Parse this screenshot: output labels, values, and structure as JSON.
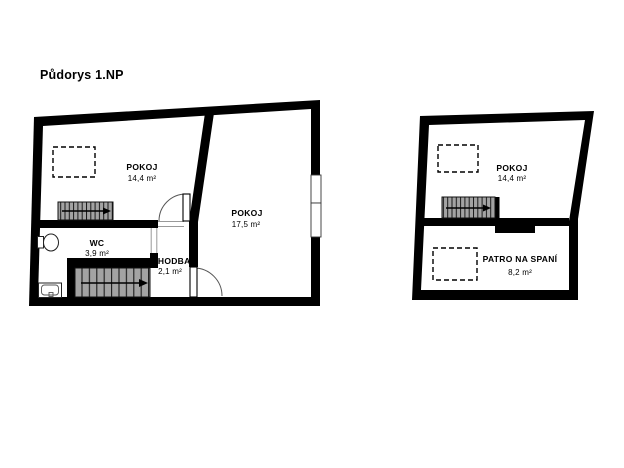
{
  "page": {
    "title": "Půdorys 1.NP",
    "background": "#ffffff"
  },
  "colors": {
    "wall": "#000000",
    "floor": "#ffffff",
    "stair_fill": "#a3a3a3",
    "tread_line": "#1a1a1a"
  },
  "plans": [
    {
      "id": "main-floor",
      "rooms": [
        {
          "label": "POKOJ",
          "area": "14,4 m²"
        },
        {
          "label": "POKOJ",
          "area": "17,5 m²"
        },
        {
          "label": "WC",
          "area": "3,9 m²"
        },
        {
          "label": "CHODBA",
          "area": "2,1 m²"
        }
      ]
    },
    {
      "id": "sleeping-loft",
      "rooms": [
        {
          "label": "POKOJ",
          "area": "14,4 m²"
        },
        {
          "label": "PATRO NA SPANÍ",
          "area": "8,2 m²"
        }
      ]
    }
  ]
}
